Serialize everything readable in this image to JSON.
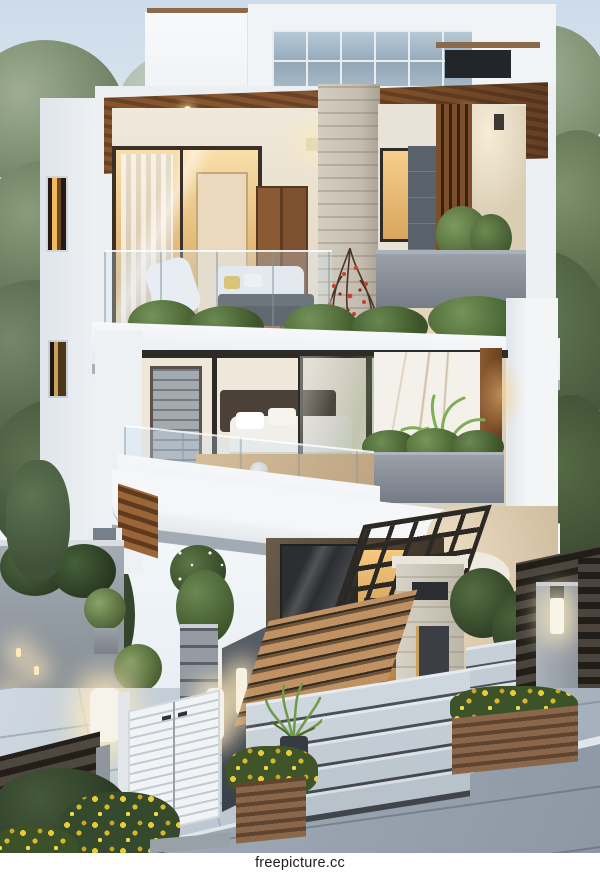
{
  "watermark": {
    "text": "freepicture.cc"
  },
  "image": {
    "kind": "3d-architectural-exterior-render",
    "time_of_day": "dusk",
    "width_px": 600,
    "height_px": 873
  },
  "palette": {
    "sky_top": "#cddcea",
    "sky_low": "#f3f7fa",
    "wall_white": "#f1f4f6",
    "wall_shadow": "#d7dde3",
    "wood_ceiling": "#7c4f2c",
    "wood_door": "#7e5030",
    "interior_warm": "#f3cd8e",
    "glass_frame": "#2e2a25",
    "clerestory_glass": "#a9bcca",
    "dark_panel": "#23272c",
    "stone_pillar": "#ccc6b9",
    "marble": "#f3f0e9",
    "marble_vein": "#b99a6e",
    "planter_gray": "#7e858d",
    "foliage_dark": "#35492e",
    "foliage_light": "#8ba07c",
    "paver": "#c2cdd7",
    "road": "#94a0ab",
    "gate_white": "#eef1f3",
    "fence_dark": "#453f38",
    "flower_yellow": "#e8c83a",
    "flower_red": "#c74134",
    "accent_glow": "#ffc878"
  },
  "scene": {
    "building": {
      "storeys": 3,
      "style": "modern-minimalist-villa",
      "features": [
        "rooftop-glass-clerestory",
        "dark-glass-panel",
        "wood-slat-balcony-ceiling",
        "recessed-downlights",
        "stone-clad-pillar",
        "red-flowering-vine",
        "glass-balustrade-terraces",
        "edge-planters-with-shrubs",
        "marble-feature-wall",
        "potted-palms",
        "floor-to-ceiling-glazing",
        "bedroom-interior-with-bed",
        "terrace-lounge-furniture",
        "curved-white-lounger",
        "steel-pergola",
        "warm-interior-lighting"
      ]
    },
    "landscape": [
      "street-trees-left",
      "street-trees-right",
      "boxwood-topiaries",
      "yellow-flower-planters",
      "privacy-hedge",
      "paved-forecourt",
      "asphalt-road"
    ],
    "entrance": [
      "white-louvered-gate",
      "stacked-stone-pillar",
      "glowing-bollard-lights",
      "horizontal-slat-fence",
      "wood-slat-ramp",
      "wide-stone-steps",
      "fence-pillar-lamp"
    ]
  }
}
